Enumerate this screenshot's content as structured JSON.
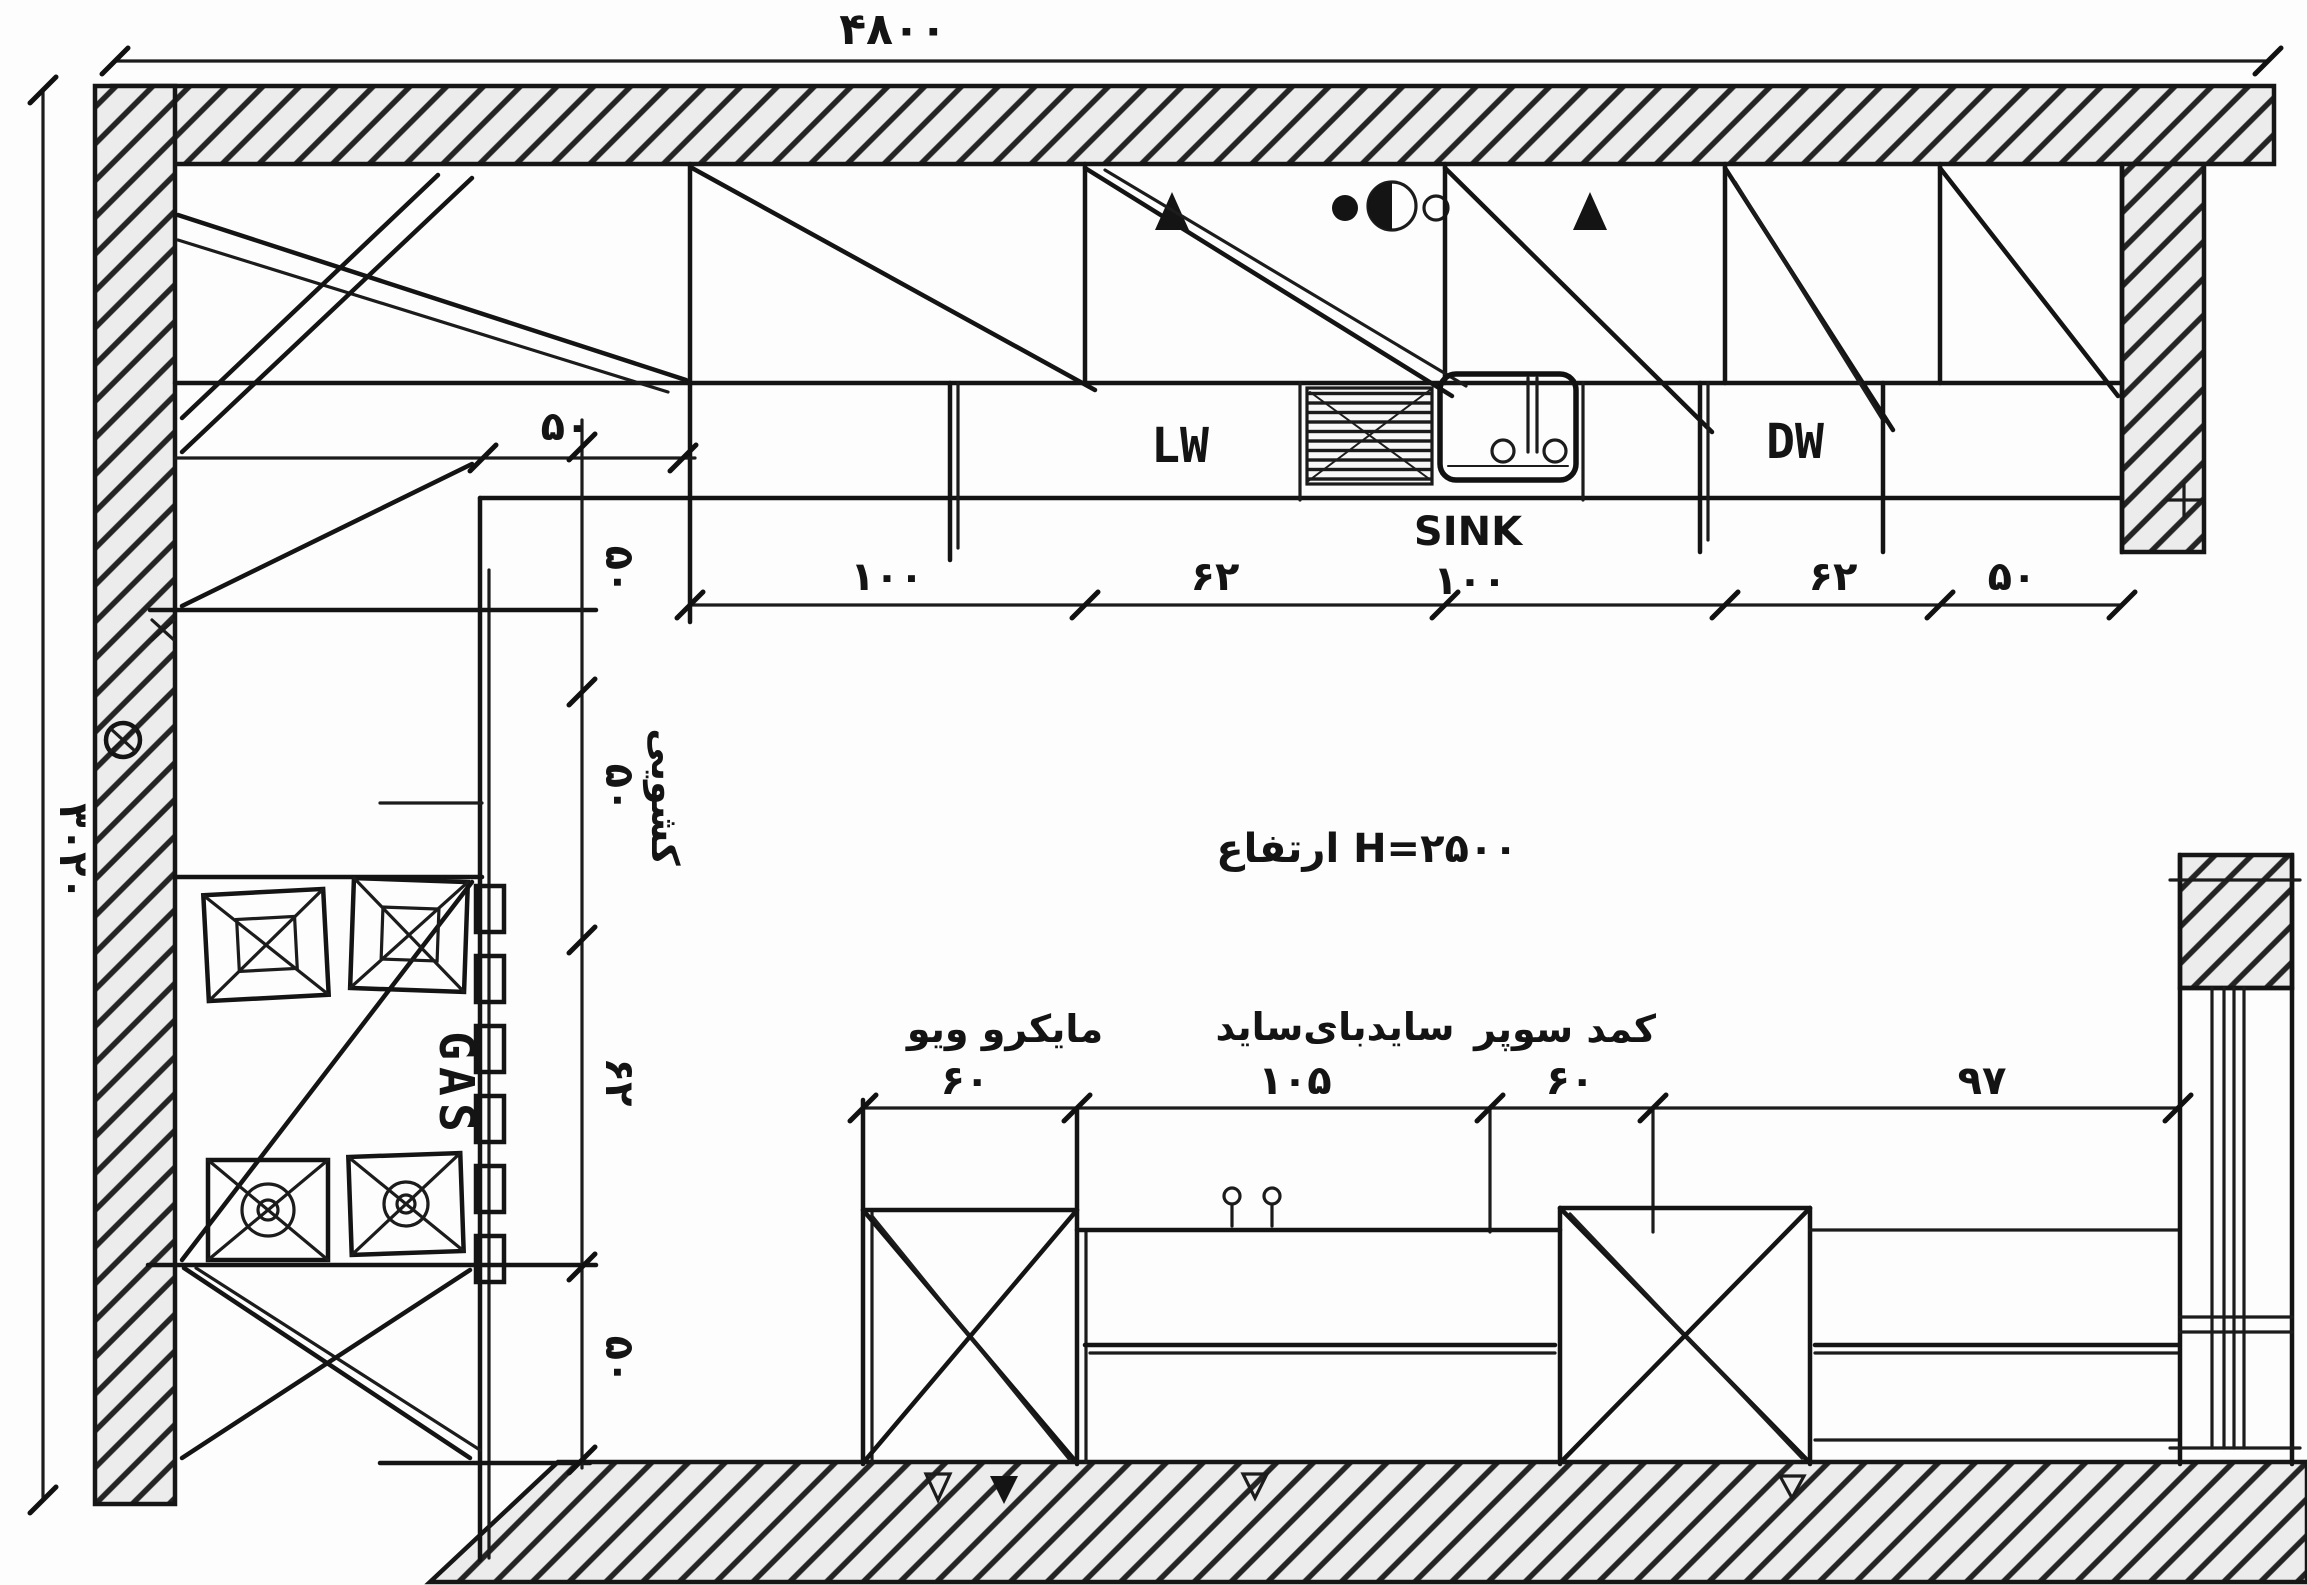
{
  "drawing": {
    "kind": "kitchen-floor-plan",
    "overall": {
      "width": "۴۸۰۰",
      "depth": "۳۰۲۰",
      "height_note": "ارتفاع H=۲۵۰۰"
    },
    "top_run": {
      "appliances": {
        "lw": "LW",
        "sink": "SINK",
        "dw": "DW"
      },
      "dims": [
        "۱۰۰",
        "۶۲",
        "۱۰۰",
        "۶۲",
        "۵۰"
      ]
    },
    "left_run": {
      "depth_dim": "۵۰",
      "dims": [
        "۵۰",
        "۵۰",
        "۶۲",
        "۵۰"
      ],
      "drawer_label": "کشویی",
      "gas_label": "GAS"
    },
    "bottom_run": {
      "labels": {
        "microwave": "مایکرو ویو",
        "side_by_side": "سایدبای‌ساید",
        "super_cabinet": "کمد سوپر"
      },
      "dims": [
        "۶۰",
        "۱۰۵",
        "۶۰",
        "۹۷"
      ]
    }
  }
}
